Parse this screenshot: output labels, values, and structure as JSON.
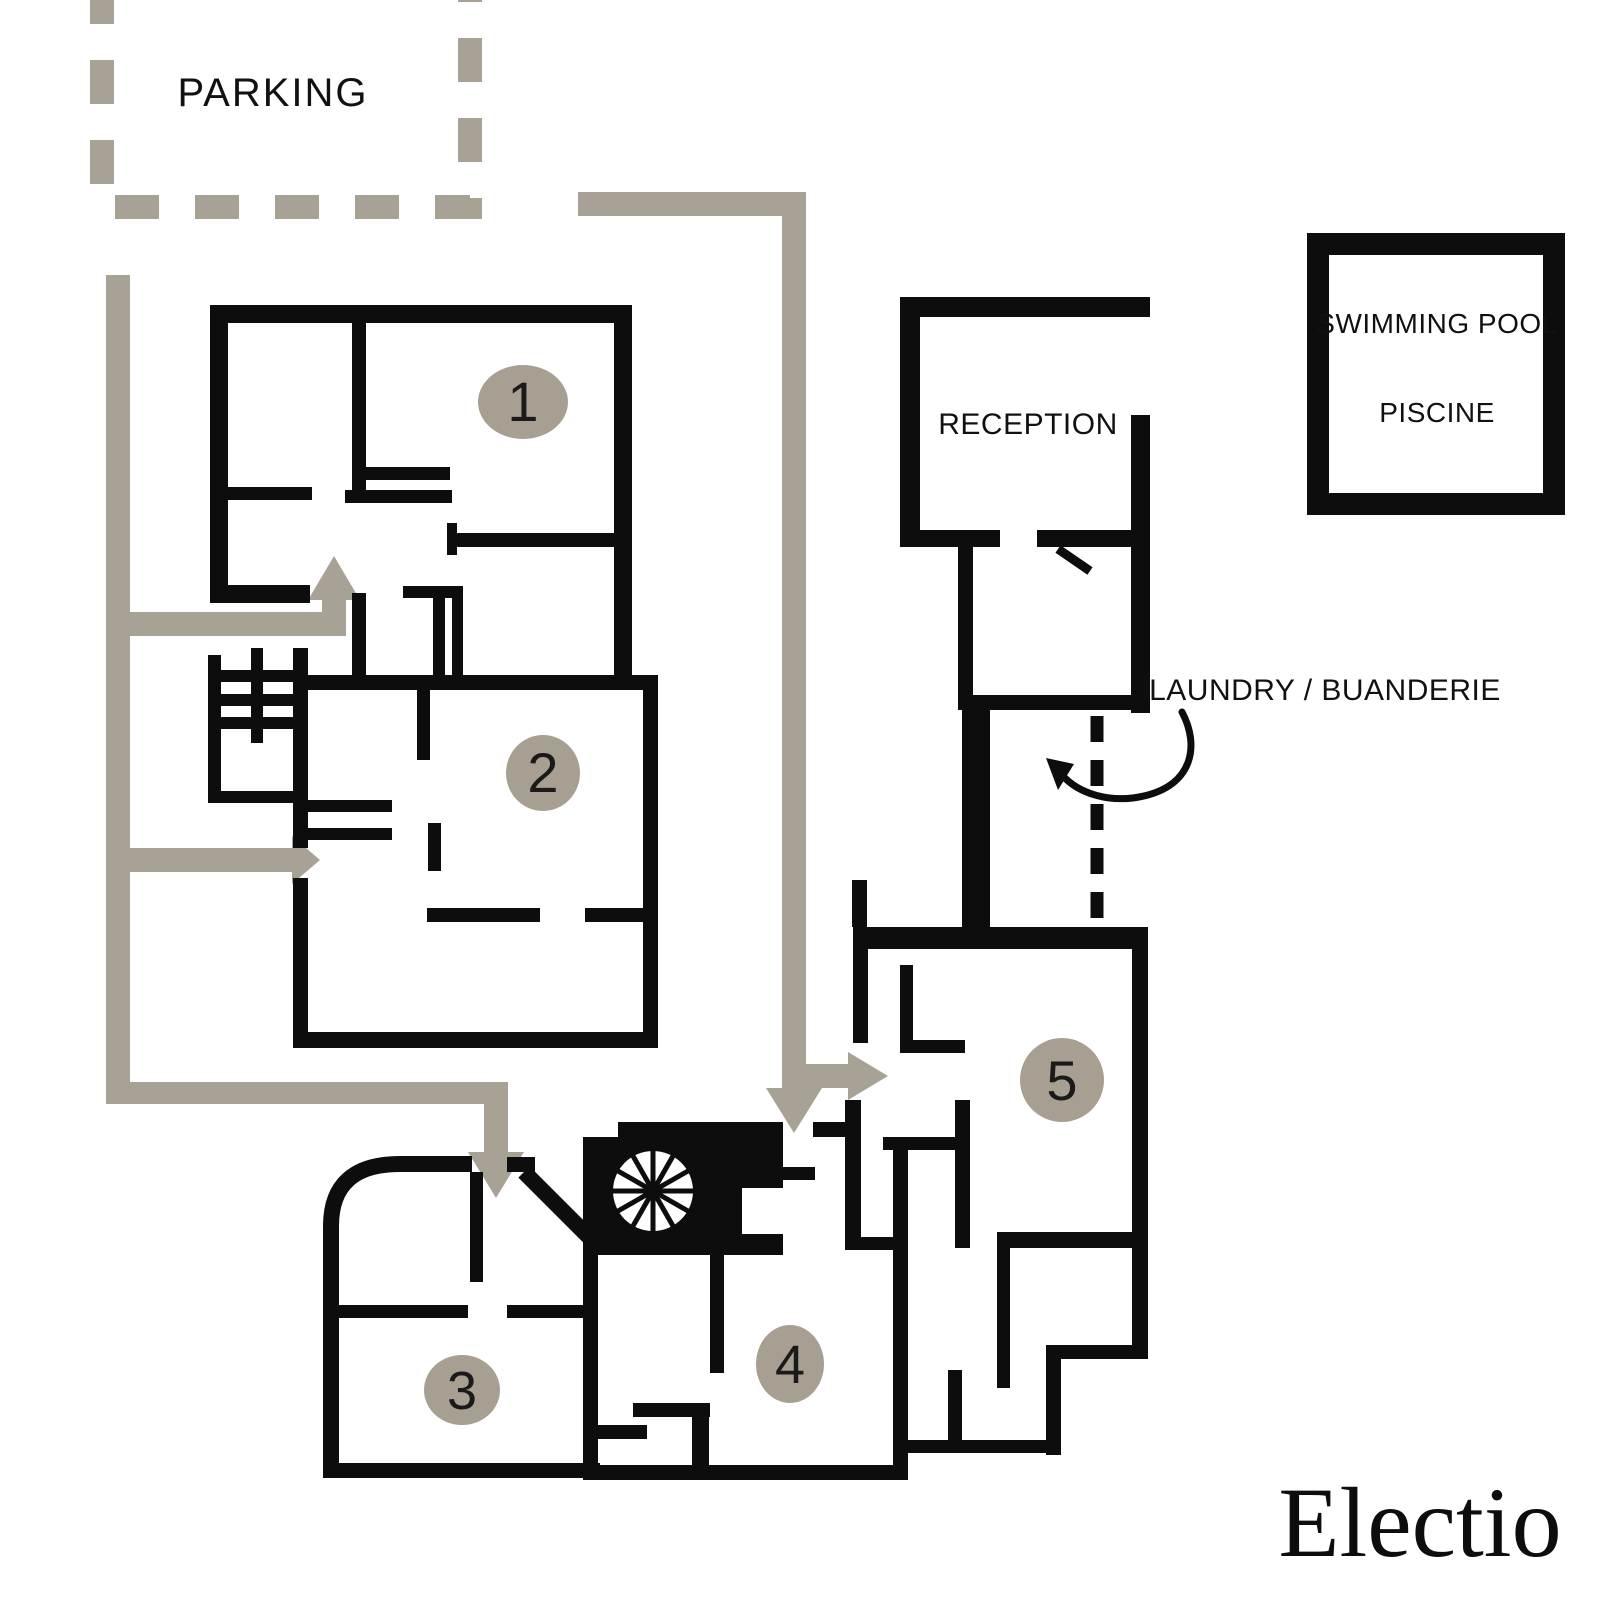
{
  "plan": {
    "parking": {
      "label": "PARKING"
    },
    "reception": {
      "label": "RECEPTION"
    },
    "swimming_pool": {
      "label_line1": "SWIMMING POOL",
      "label_line2": "PISCINE"
    },
    "laundry": {
      "label": "LAUNDRY / BUANDERIE"
    },
    "buildings": [
      {
        "number": "1"
      },
      {
        "number": "2"
      },
      {
        "number": "3"
      },
      {
        "number": "4"
      },
      {
        "number": "5"
      }
    ],
    "logo": {
      "text": "Electio"
    },
    "colors": {
      "wall": "#0d0d0d",
      "route": "#a8a296",
      "badge": "#a69f92",
      "text": "#111111",
      "background": "#ffffff"
    }
  }
}
